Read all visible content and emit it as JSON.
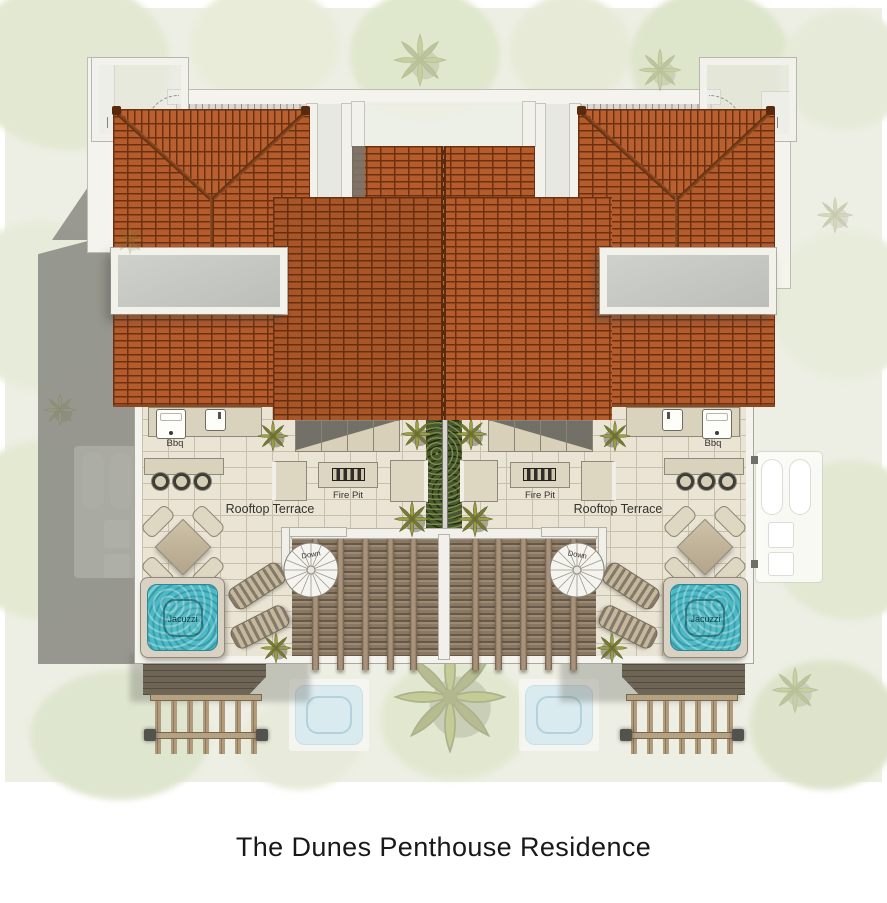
{
  "title": "The Dunes Penthouse Residence",
  "colors": {
    "roof_tile": "#b45c2c",
    "roof_ridge": "#6b3413",
    "terrace_floor": "#eae4d4",
    "wall_white": "#f4f3ed",
    "jacuzzi_water": "#4cbac6",
    "hedge_green": "#49562f",
    "deck_wood": "#8a7862",
    "landscape_base": "#edefe4",
    "pool_faded": "#d7ebf3"
  },
  "units": [
    {
      "side": "left",
      "terrace_label": "Rooftop Terrace",
      "bbq_label": "Bbq",
      "fire_pit_label": "Fire Pit",
      "jacuzzi_label": "Jacuzzi",
      "stairs_label": "Down"
    },
    {
      "side": "right",
      "terrace_label": "Rooftop Terrace",
      "bbq_label": "Bbq",
      "fire_pit_label": "Fire Pit",
      "jacuzzi_label": "Jacuzzi",
      "stairs_label": "Down"
    }
  ]
}
